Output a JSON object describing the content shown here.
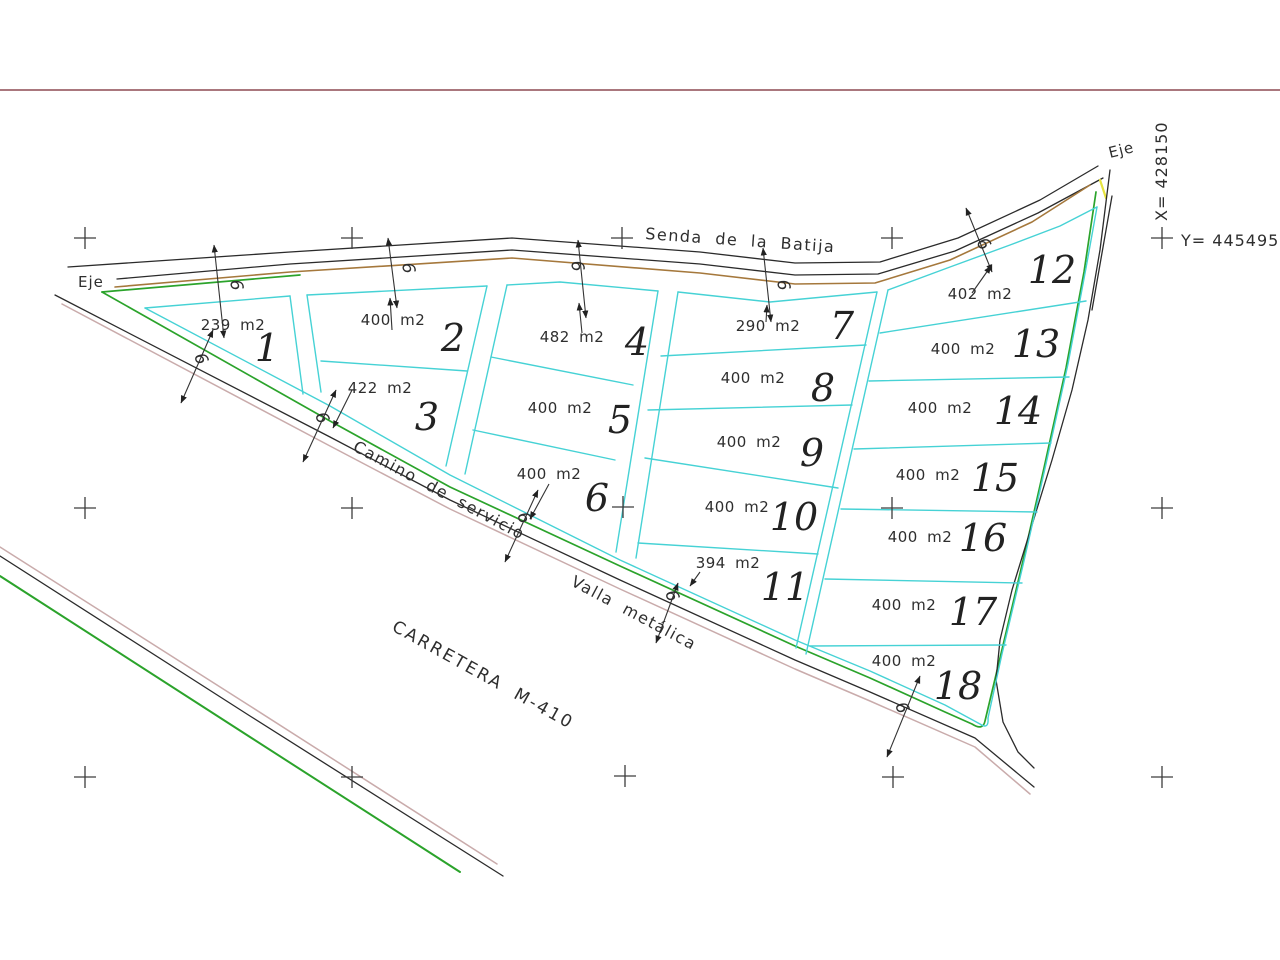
{
  "colors": {
    "cyan": "#46d2d5",
    "green": "#2ba32b",
    "brown": "#a5783c",
    "pink": "#c9abab",
    "yellow": "#e6e33e",
    "red_rule": "#8e4a52",
    "line_black": "#2b2b2b",
    "text": "#2e2e2e"
  },
  "labels": {
    "senda": "Senda de la Batija",
    "camino": "Camino de servicio",
    "valla": "Valla metálica",
    "carretera": "CARRETERA M-410",
    "eje_left": "Eje",
    "eje_right": "Eje",
    "coord_x": "X= 428150",
    "coord_y": "Y= 4454950",
    "dim_width": "6"
  },
  "plots": [
    {
      "number": "1",
      "area": "239 m2"
    },
    {
      "number": "2",
      "area": "400 m2"
    },
    {
      "number": "3",
      "area": "422 m2"
    },
    {
      "number": "4",
      "area": "482 m2"
    },
    {
      "number": "5",
      "area": "400 m2"
    },
    {
      "number": "6",
      "area": "400 m2"
    },
    {
      "number": "7",
      "area": "290 m2"
    },
    {
      "number": "8",
      "area": "400 m2"
    },
    {
      "number": "9",
      "area": "400 m2"
    },
    {
      "number": "10",
      "area": "400 m2"
    },
    {
      "number": "11",
      "area": "394 m2"
    },
    {
      "number": "12",
      "area": "402 m2"
    },
    {
      "number": "13",
      "area": "400 m2"
    },
    {
      "number": "14",
      "area": "400 m2"
    },
    {
      "number": "15",
      "area": "400 m2"
    },
    {
      "number": "16",
      "area": "400 m2"
    },
    {
      "number": "17",
      "area": "400 m2"
    },
    {
      "number": "18",
      "area": "400 m2"
    }
  ]
}
